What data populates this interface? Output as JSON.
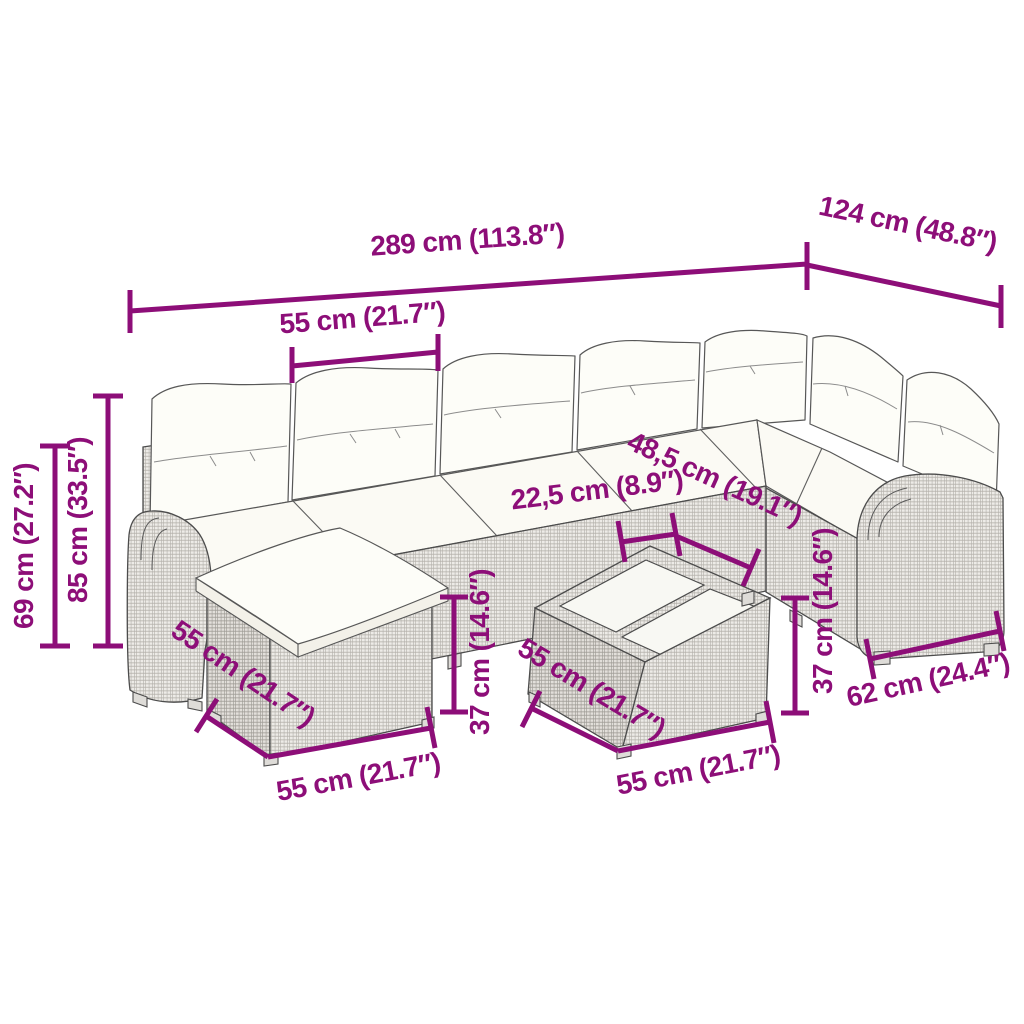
{
  "figure": {
    "type": "product-dimension-diagram",
    "subject": "rattan garden lounge set with ottoman and coffee table",
    "background_color": "#ffffff",
    "accent_color": "#8d0e78",
    "linework_color": "#4c4c4c",
    "labels": {
      "total_length": "289 cm (113.8″)",
      "wing_length": "124 cm (48.8″)",
      "seat_width": "55 cm (21.7″)",
      "armrest_height": "69 cm (27.2″)",
      "back_height": "85 cm (33.5″)",
      "corner_armrest_width": "22,5 cm (8.9″)",
      "seat_depth": "48,5 cm (19.1″)",
      "ottoman_height": "37 cm (14.6″)",
      "ottoman_side_length": "55 cm (21.7″)",
      "ottoman_front_length": "55 cm (21.7″)",
      "table_height": "37 cm (14.6″)",
      "table_side_length": "55 cm (21.7″)",
      "table_front_length": "55 cm (21.7″)",
      "wing_seat_width": "62 cm (24.4″)"
    }
  }
}
